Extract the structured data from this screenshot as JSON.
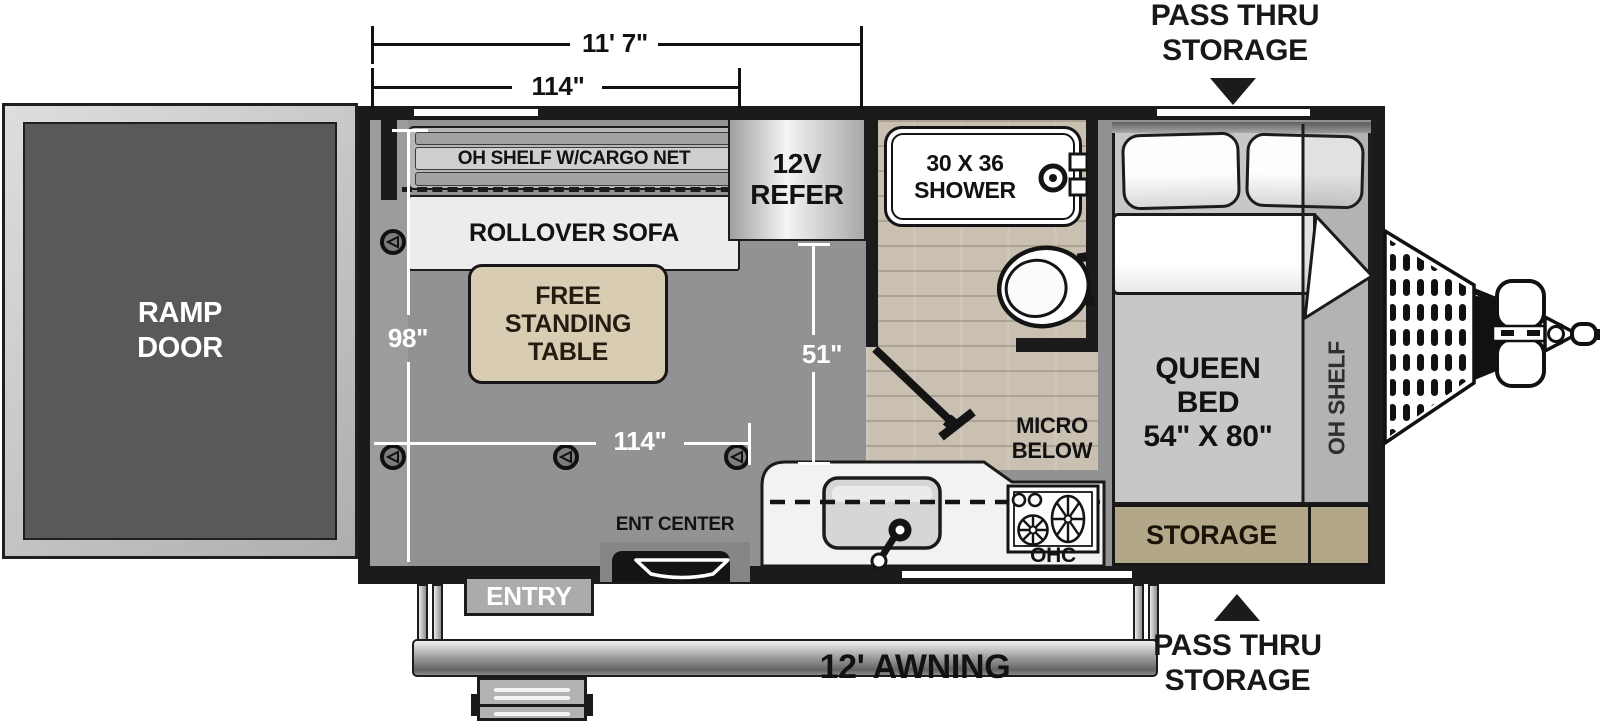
{
  "title": "Toy hauler travel trailer floorplan",
  "labels": {
    "ramp_door": "RAMP\nDOOR",
    "oh_shelf_cargo_net": "OH SHELF W/CARGO NET",
    "rollover_sofa": "ROLLOVER SOFA",
    "free_standing_table": "FREE\nSTANDING\nTABLE",
    "refer": "12V\nREFER",
    "shower": "30 X 36\nSHOWER",
    "queen_bed": "QUEEN\nBED\n54\" X 80\"",
    "oh_shelf": "OH SHELF",
    "storage": "STORAGE",
    "micro_below": "MICRO\nBELOW",
    "ohc": "OHC",
    "ent_center": "ENT CENTER",
    "entry": "ENTRY",
    "awning": "12' AWNING",
    "pass_thru_top": "PASS THRU\nSTORAGE",
    "pass_thru_bottom": "PASS THRU\nSTORAGE"
  },
  "dimensions": {
    "overall_length": "11' 7\"",
    "box_length_top": "114\"",
    "interior_width": "98\"",
    "floor_length": "114\"",
    "galley_depth": "51\""
  },
  "colors": {
    "wall": "#1b1b1b",
    "floor": "#929294",
    "wood_floor": "#c9c0b1",
    "storage_tan": "#b3a78a",
    "table_tan": "#d8cdb2",
    "ramp_door_panel": "#59595b",
    "dimension_text_on_floor": "#ffffff",
    "dimension_text_outside": "#111111"
  }
}
